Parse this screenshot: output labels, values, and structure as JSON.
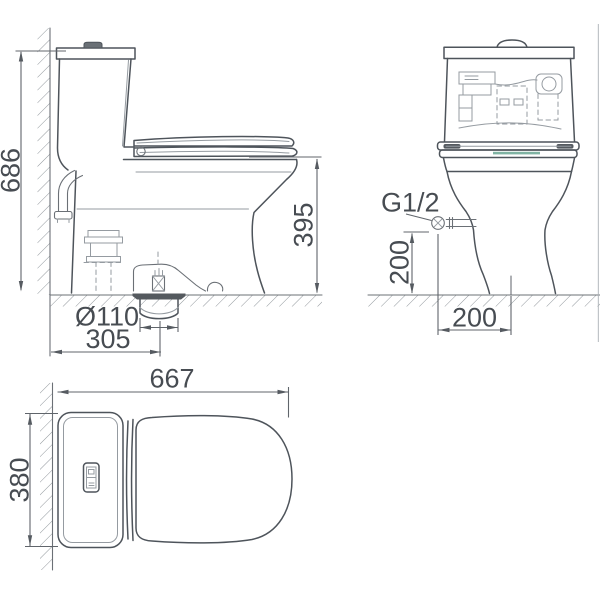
{
  "drawing": {
    "type": "toilet-technical-dimension-drawing",
    "views": {
      "side": {
        "name": "side view",
        "dim_overall_height": "686",
        "dim_seat_height": "395",
        "dim_outlet_diameter": "Ø110",
        "dim_outlet_from_wall": "305"
      },
      "front": {
        "name": "front view",
        "label_inlet_thread": "G1/2",
        "dim_inlet_height": "200",
        "dim_inlet_offset": "200"
      },
      "top": {
        "name": "top view",
        "dim_overall_length": "667",
        "dim_overall_width": "380"
      }
    },
    "colors": {
      "outline": "#4e545b",
      "dimension_lines": "#60656b",
      "dimension_text": "#474c52",
      "light_detail": "#959ba1",
      "hatch": "#858b91",
      "flange_fill": "#54595e",
      "seal_accent_teal": "#7fb3a3",
      "background": "#ffffff"
    }
  }
}
